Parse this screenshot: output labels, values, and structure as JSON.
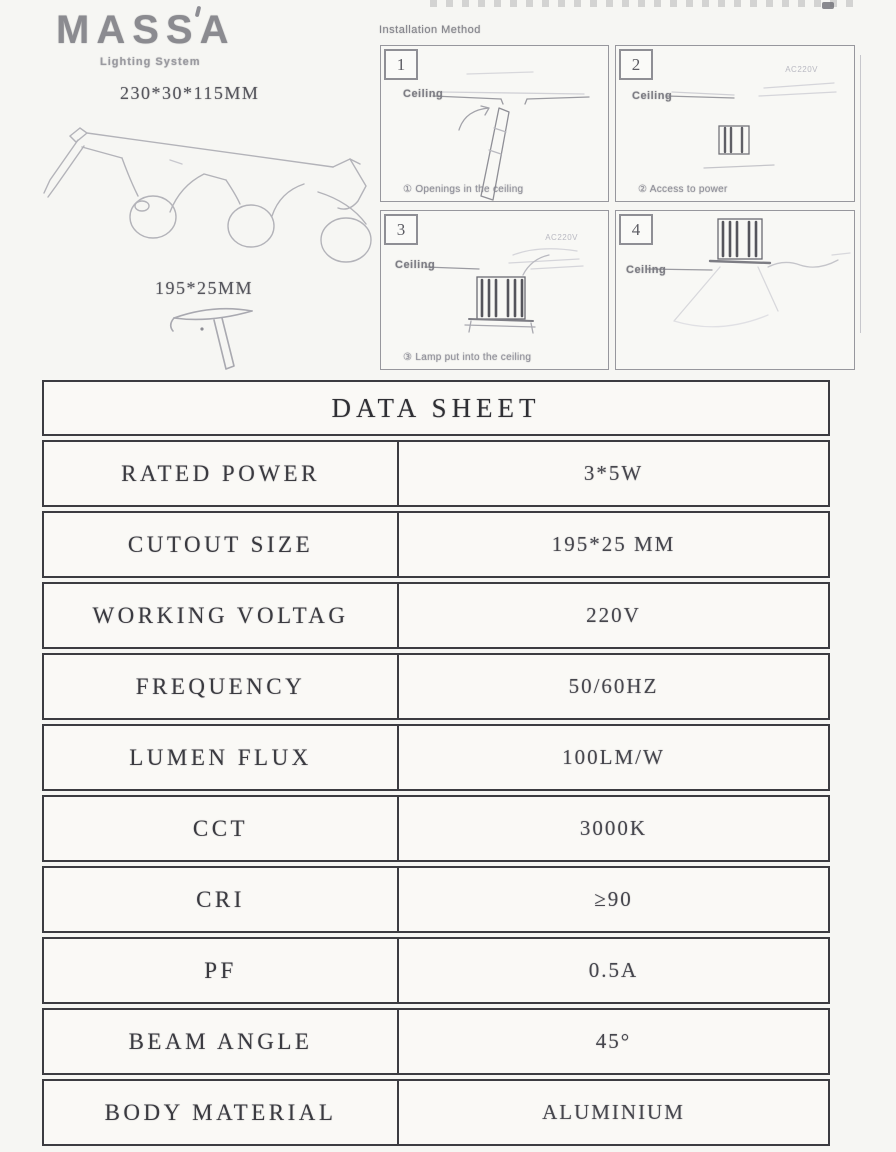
{
  "logo": {
    "text": "MASSA",
    "subtitle": "Lighting System"
  },
  "product": {
    "fixture_dimensions": "230*30*115MM",
    "cutout_dimensions": "195*25MM"
  },
  "installation": {
    "title": "Installation Method",
    "panels": [
      {
        "number": "1",
        "ceiling_label": "Ceiling",
        "caption": "① Openings in the ceiling",
        "annotation": ""
      },
      {
        "number": "2",
        "ceiling_label": "Ceiling",
        "caption": "② Access to power",
        "annotation": "AC220V"
      },
      {
        "number": "3",
        "ceiling_label": "Ceiling",
        "caption": "③ Lamp put into the ceiling",
        "annotation": "AC220V"
      },
      {
        "number": "4",
        "ceiling_label": "Ceiling",
        "caption": "",
        "annotation": ""
      }
    ]
  },
  "datasheet": {
    "title": "DATA SHEET",
    "rows": [
      {
        "label": "RATED POWER",
        "value": "3*5W"
      },
      {
        "label": "CUTOUT SIZE",
        "value": "195*25 MM"
      },
      {
        "label": "WORKING VOLTAG",
        "value": "220V"
      },
      {
        "label": "FREQUENCY",
        "value": "50/60HZ"
      },
      {
        "label": "LUMEN FLUX",
        "value": "100LM/W"
      },
      {
        "label": "CCT",
        "value": "3000K"
      },
      {
        "label": "CRI",
        "value": "≥90"
      },
      {
        "label": "PF",
        "value": "0.5A"
      },
      {
        "label": "BEAM ANGLE",
        "value": "45°"
      },
      {
        "label": "BODY MATERIAL",
        "value": "ALUMINIUM"
      }
    ]
  },
  "colors": {
    "background": "#f6f6f3",
    "table_border": "#3c3c41",
    "ink": "#3a3a40",
    "logo_gray": "#8b8b90",
    "sketch_gray": "#b3b3b9"
  }
}
